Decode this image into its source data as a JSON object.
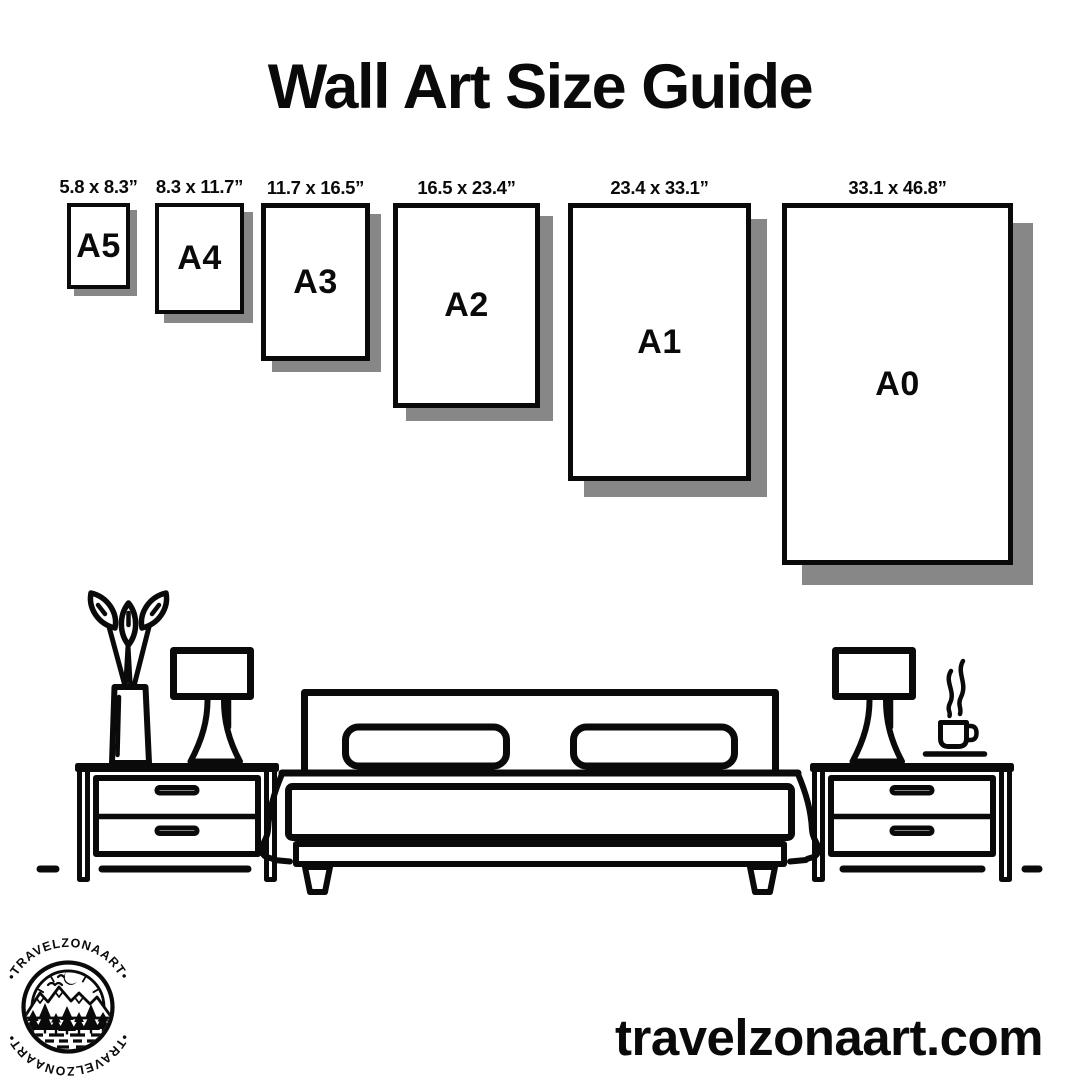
{
  "title": "Wall Art Size Guide",
  "sizes": [
    {
      "label": "A5",
      "dimensions": "5.8 x 8.3”"
    },
    {
      "label": "A4",
      "dimensions": "8.3 x 11.7”"
    },
    {
      "label": "A3",
      "dimensions": "11.7 x 16.5”"
    },
    {
      "label": "A2",
      "dimensions": "16.5 x 23.4”"
    },
    {
      "label": "A1",
      "dimensions": "23.4 x 33.1”"
    },
    {
      "label": "A0",
      "dimensions": "33.1 x 46.8”"
    }
  ],
  "logo": {
    "brand": "TRAVELZONAART",
    "arc_text": "•TRAVELZONAART•"
  },
  "footer": {
    "website": "travelzonaart.com"
  },
  "colors": {
    "ink": "#0a0a0a",
    "shadow": "#878787",
    "background": "#ffffff"
  },
  "scene": {
    "icons": [
      "nightstand-icon",
      "table-lamp-icon",
      "vase-with-flowers-icon",
      "double-bed-icon",
      "pillow-icon",
      "coffee-cup-icon",
      "steam-icon",
      "moon-icon",
      "mountains-icon",
      "pine-trees-icon"
    ]
  }
}
